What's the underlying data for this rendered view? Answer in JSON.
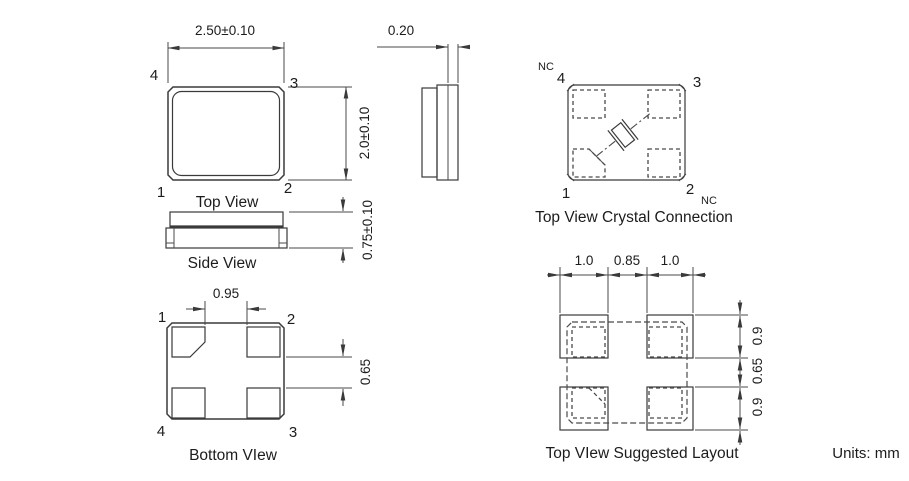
{
  "drawing": {
    "units_label": "Units: mm",
    "top_view": {
      "caption": "Top View",
      "dim_width": "2.50±0.10",
      "dim_height": "2.0±0.10",
      "pin_tl": "4",
      "pin_tr": "3",
      "pin_bl": "1",
      "pin_br": "2"
    },
    "side_view": {
      "caption": "Side View",
      "dim_height": "0.75±0.10"
    },
    "end_view": {
      "dim_pad_thickness": "0.20"
    },
    "crystal_connection": {
      "caption": "Top View Crystal Connection",
      "nc_top": "NC",
      "pin_tl": "4",
      "pin_tr": "3",
      "pin_bl": "1",
      "pin_br": "2",
      "nc_bottom": "NC"
    },
    "bottom_view": {
      "caption": "Bottom VIew",
      "dim_pad_inner_gap": "0.95",
      "dim_pad_gap_vertical": "0.65",
      "pin_tl": "1",
      "pin_tr": "2",
      "pin_bl": "4",
      "pin_br": "3"
    },
    "suggested_layout": {
      "caption": "Top VIew Suggested Layout",
      "dim_pad_width_left": "1.0",
      "dim_pad_gap_x": "0.85",
      "dim_pad_width_right": "1.0",
      "dim_pad_height_top": "0.9",
      "dim_pad_gap_y": "0.65",
      "dim_pad_height_bottom": "0.9"
    }
  }
}
